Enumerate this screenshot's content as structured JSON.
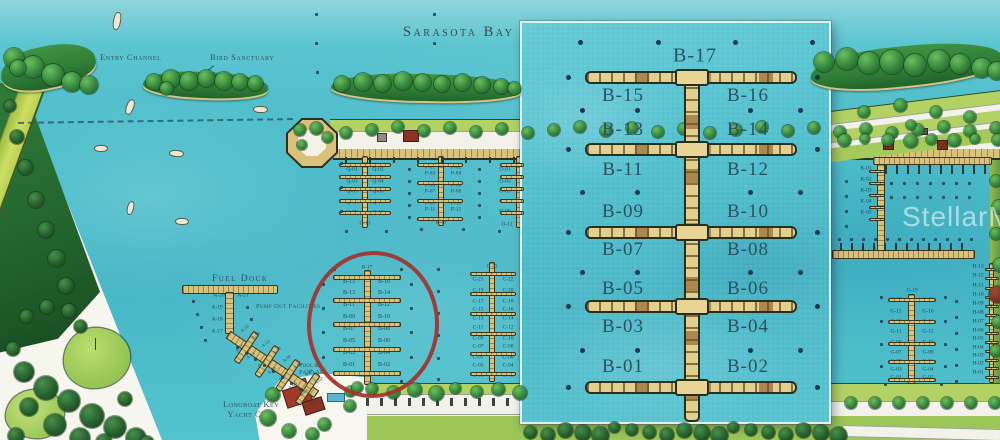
{
  "labels": {
    "bay": "Sarasota Bay",
    "entry_channel": "Entry Channel",
    "bird_sanctuary": "Bird Sanctuary",
    "fuel_dock": "Fuel Dock",
    "pump_out": "Pump Out Facilities",
    "pool_line1": "Pool &",
    "pool_line2": "Patio Area",
    "yc_line1": "Longboat Key",
    "yc_line2": "Yacht Club",
    "watermark": "StellarMLS"
  },
  "inset": {
    "top_slip": "B-17",
    "pairs": [
      [
        "B-15",
        "B-16"
      ],
      [
        "B-13",
        "B-14"
      ],
      [
        "B-11",
        "B-12"
      ],
      [
        "B-09",
        "B-10"
      ],
      [
        "B-07",
        "B-08"
      ],
      [
        "B-05",
        "B-06"
      ],
      [
        "B-03",
        "B-04"
      ],
      [
        "B-01",
        "B-02"
      ]
    ]
  },
  "docks": {
    "b": {
      "top": "B-17",
      "pairs": [
        [
          "B-15",
          "B-16"
        ],
        [
          "B-13",
          "B-14"
        ],
        [
          "B-11",
          "B-12"
        ],
        [
          "B-09",
          "B-10"
        ],
        [
          "B-07",
          "B-08"
        ],
        [
          "B-05",
          "B-06"
        ],
        [
          "B-03",
          "B-04"
        ],
        [
          "B-01",
          "B-02"
        ]
      ]
    },
    "c": {
      "top": "C-23",
      "pairs": [
        [
          "C-21",
          "C-22"
        ],
        [
          "C-19",
          "C-20"
        ],
        [
          "C-17",
          "C-18"
        ],
        [
          "C-15",
          "C-16"
        ],
        [
          "C-13",
          "C-14"
        ],
        [
          "C-11",
          "C-12"
        ],
        [
          "C-09",
          "C-10"
        ],
        [
          "C-07",
          "C-08"
        ],
        [
          "C-05",
          "C-06"
        ],
        [
          "C-03",
          "C-04"
        ],
        [
          "C-01",
          "C-02"
        ]
      ]
    },
    "q": {
      "end": "Q-11",
      "pairs": [
        [
          "Q-01",
          "Q-02"
        ],
        [
          "Q-03",
          "Q-04"
        ],
        [
          "Q-05",
          "Q-06"
        ],
        [
          "Q-07",
          "Q-08"
        ],
        [
          "Q-09",
          "Q-10"
        ]
      ]
    },
    "p": {
      "end": "P-13",
      "pairs": [
        [
          "P-01",
          "P-02"
        ],
        [
          "P-03",
          "P-04"
        ],
        [
          "P-05",
          "P-06"
        ],
        [
          "P-07",
          "P-08"
        ],
        [
          "P-09",
          "P-10"
        ],
        [
          "P-11",
          "P-12"
        ]
      ]
    },
    "o": {
      "end": "O-11",
      "left": [
        "O-01",
        "O-03",
        "O-05",
        "O-07",
        "O-09"
      ]
    },
    "a_top": [
      "A-20",
      "A-21"
    ],
    "a_side": [
      "A-19",
      "A-18",
      "A-17"
    ],
    "a_diag": [
      "A-16",
      "A-15",
      "A-14",
      "A-13",
      "A-12",
      "A-11",
      "A-10",
      "A-09",
      "A-08",
      "A-07",
      "A-06",
      "A-05",
      "A-04",
      "A-03",
      "A-02",
      "A-01"
    ],
    "k": [
      "K-01",
      "K-02",
      "K-03",
      "K-04",
      "K-05"
    ],
    "g": {
      "top": "G-19",
      "pairs": [
        [
          "G-17",
          "G-18"
        ],
        [
          "G-15",
          "G-16"
        ],
        [
          "G-13",
          "G-14"
        ],
        [
          "G-11",
          "G-12"
        ],
        [
          "G-09",
          "G-10"
        ],
        [
          "G-07",
          "G-08"
        ],
        [
          "G-05",
          "G-06"
        ],
        [
          "G-03",
          "G-04"
        ],
        [
          "G-01",
          "G-02"
        ]
      ]
    },
    "h": [
      "H-13",
      "H-12",
      "H-11",
      "H-10",
      "H-09",
      "H-08",
      "H-07",
      "H-06",
      "H-05",
      "H-04",
      "H-03",
      "H-02",
      "H-01"
    ]
  }
}
